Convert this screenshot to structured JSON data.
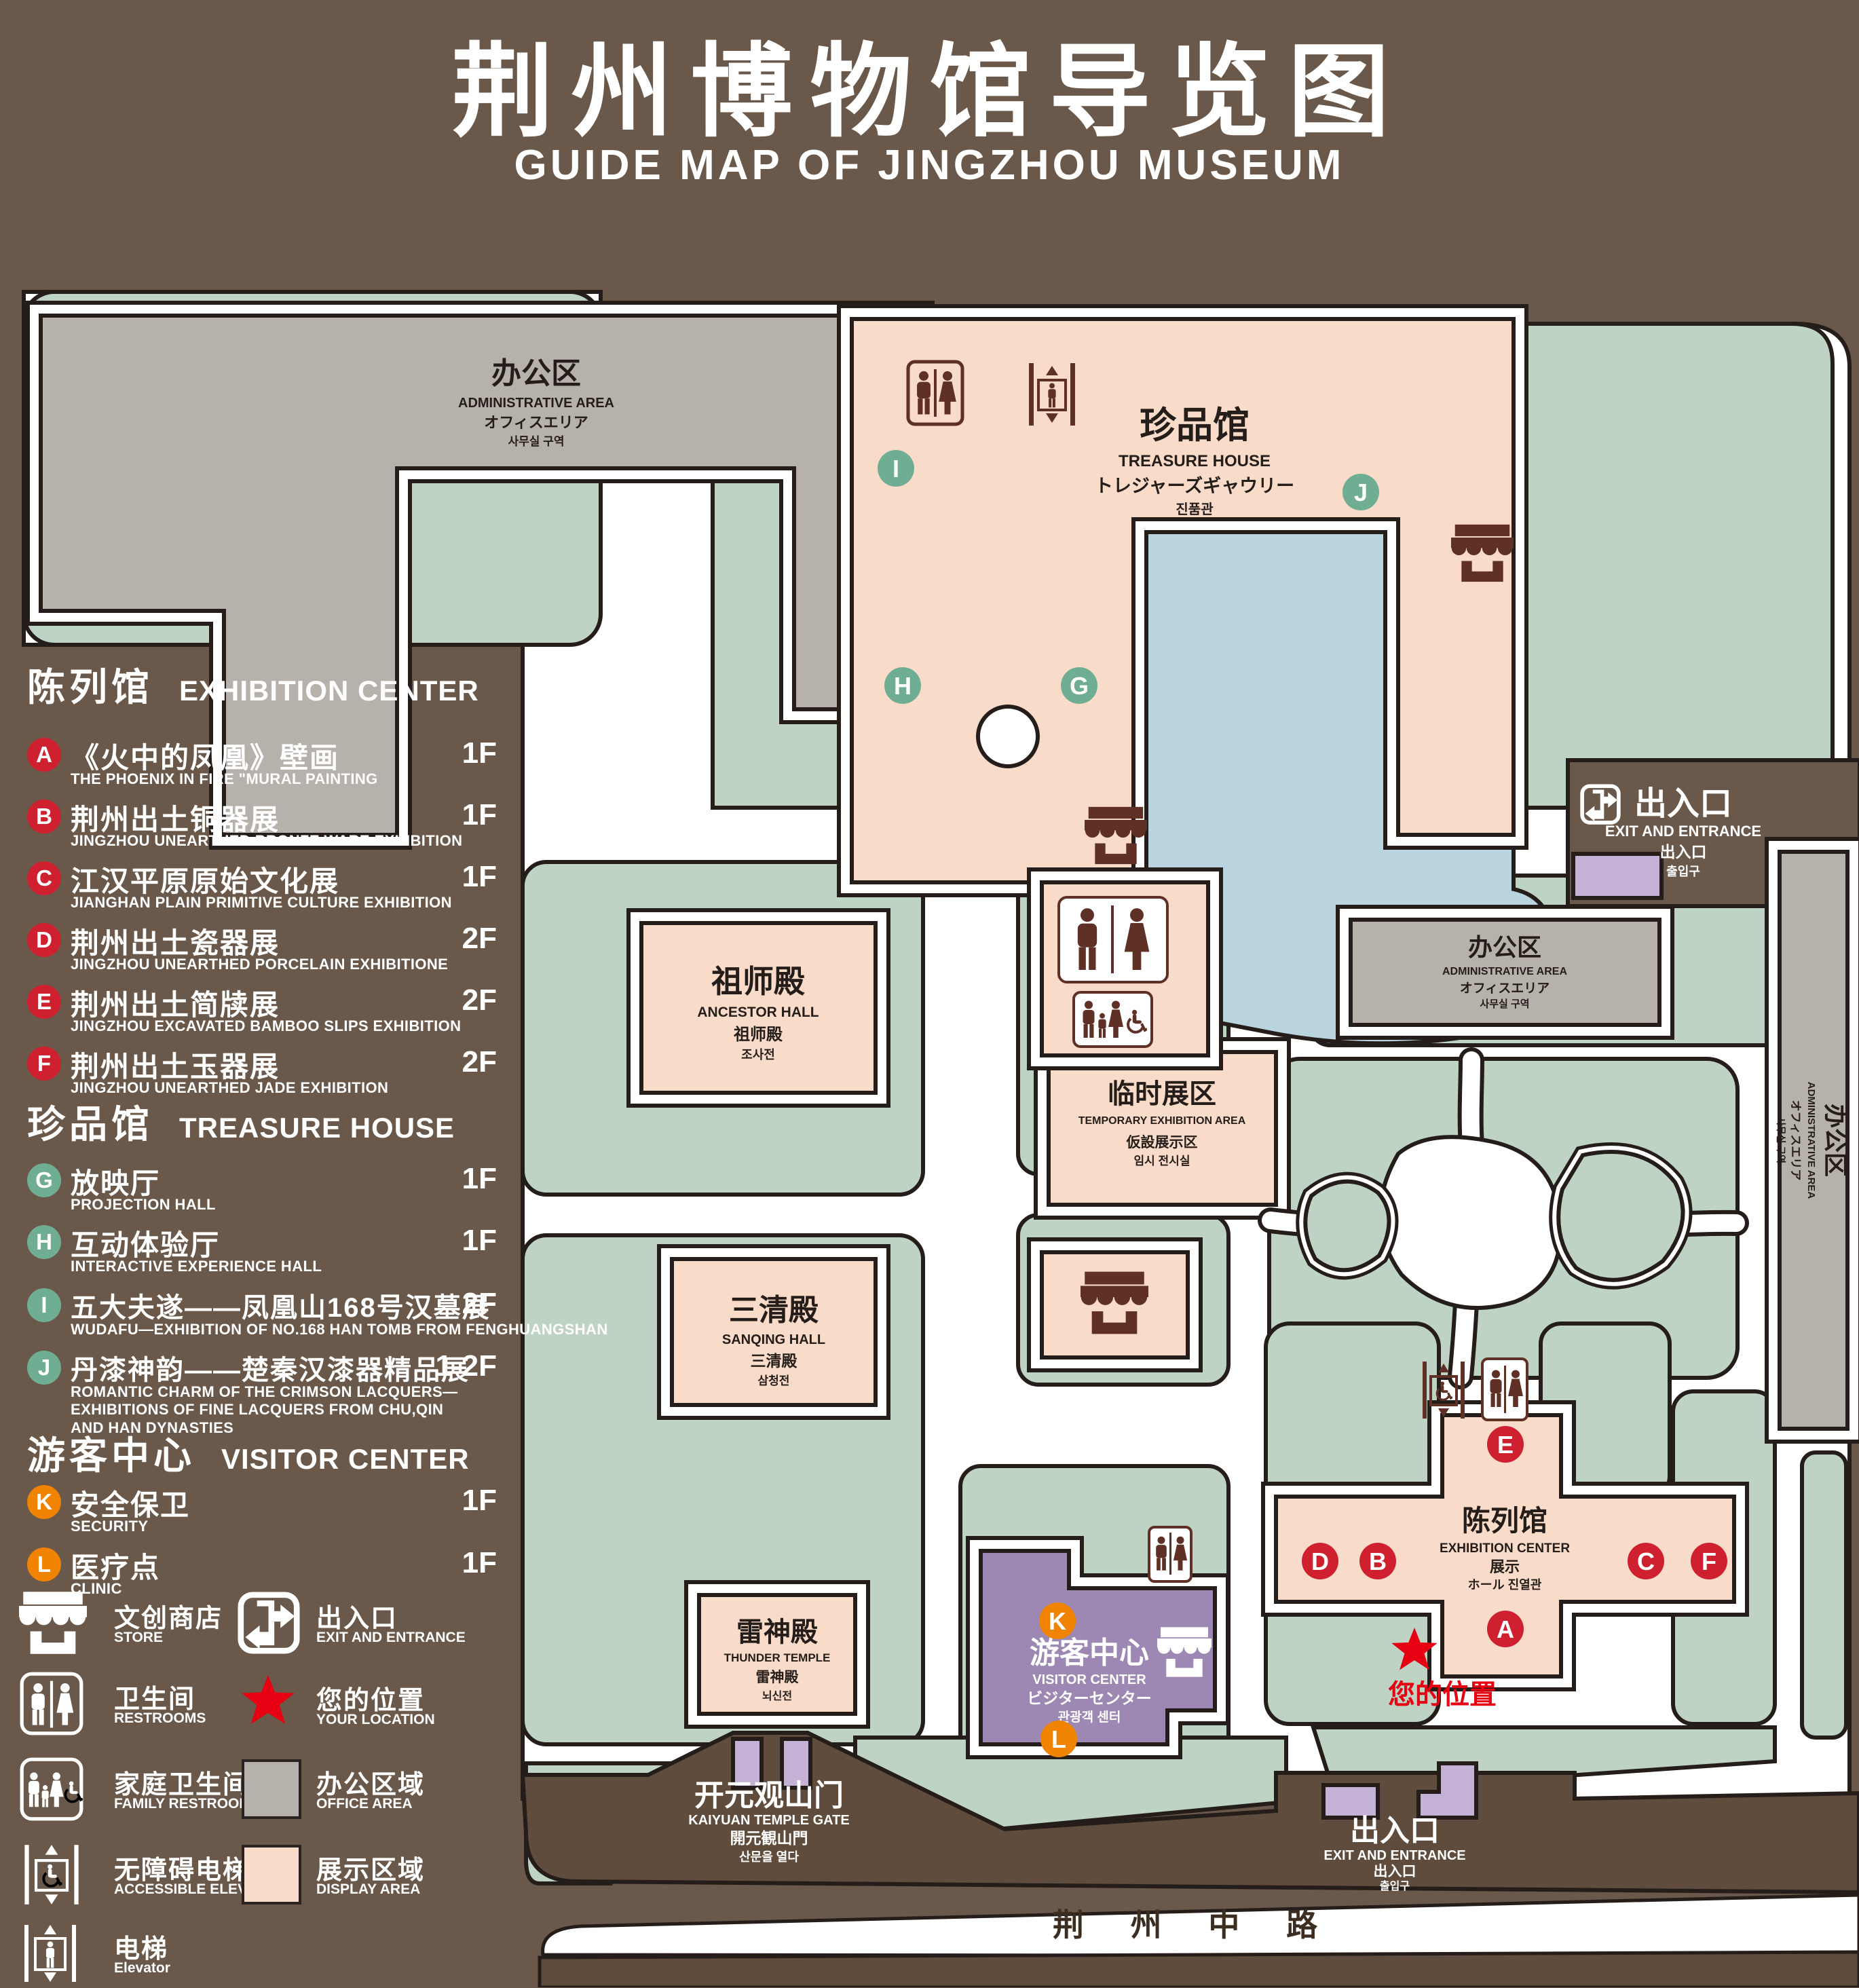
{
  "title": {
    "zh": "荆州博物馆导览图",
    "en": "GUIDE MAP OF JINGZHOU MUSEUM"
  },
  "colors": {
    "background": "#6a594b",
    "road": "#5f4c3c",
    "green_area": "#bfd3c4",
    "display_area": "#f8dbc9",
    "office_area": "#b7b1ac",
    "pond": "#b9d4df",
    "visitor_center": "#9c88b2",
    "gate_booth": "#c4b2d6",
    "badge_exhibition": "#cf2030",
    "badge_treasure": "#6fae92",
    "badge_visitor": "#f08300",
    "icon_brown": "#5e3026",
    "location_red": "#e60012"
  },
  "legend": {
    "sections": [
      {
        "zh": "陈列馆",
        "en": "EXHIBITION CENTER",
        "items": [
          {
            "letter": "A",
            "zh": "《火中的凤凰》壁画",
            "en": "THE PHOENIX IN FIRE \"MURAL PAINTING",
            "floor": "1F"
          },
          {
            "letter": "B",
            "zh": "荆州出土铜器展",
            "en": "JINGZHOU UNEARTHED BRONZE WARE EXHIBITION",
            "floor": "1F"
          },
          {
            "letter": "C",
            "zh": "江汉平原原始文化展",
            "en": "JIANGHAN PLAIN PRIMITIVE CULTURE EXHIBITION",
            "floor": "1F"
          },
          {
            "letter": "D",
            "zh": "荆州出土瓷器展",
            "en": "JINGZHOU UNEARTHED PORCELAIN EXHIBITIONE",
            "floor": "2F"
          },
          {
            "letter": "E",
            "zh": "荆州出土简牍展",
            "en": "JINGZHOU EXCAVATED BAMBOO SLIPS EXHIBITION",
            "floor": "2F"
          },
          {
            "letter": "F",
            "zh": "荆州出土玉器展",
            "en": "JINGZHOU UNEARTHED JADE EXHIBITION",
            "floor": "2F"
          }
        ]
      },
      {
        "zh": "珍品馆",
        "en": "TREASURE HOUSE",
        "items": [
          {
            "letter": "G",
            "zh": "放映厅",
            "en": "PROJECTION HALL",
            "floor": "1F"
          },
          {
            "letter": "H",
            "zh": "互动体验厅",
            "en": "INTERACTIVE EXPERIENCE HALL",
            "floor": "1F"
          },
          {
            "letter": "I",
            "zh": "五大夫遂——凤凰山168号汉墓展",
            "en": "WUDAFU—EXHIBITION OF NO.168 HAN TOMB FROM FENGHUANGSHAN",
            "floor": "2F"
          },
          {
            "letter": "J",
            "zh": "丹漆神韵——楚秦汉漆器精品展",
            "en": "ROMANTIC CHARM OF THE CRIMSON LACQUERS—EXHIBITIONS OF FINE LACQUERS FROM CHU,QIN AND HAN DYNASTIES",
            "floor": "1-2F"
          }
        ]
      },
      {
        "zh": "游客中心",
        "en": "VISITOR CENTER",
        "items": [
          {
            "letter": "K",
            "zh": "安全保卫",
            "en": "SECURITY",
            "floor": "1F"
          },
          {
            "letter": "L",
            "zh": "医疗点",
            "en": "CLINIC",
            "floor": "1F"
          }
        ]
      }
    ],
    "symbols": [
      {
        "icon": "store-icon",
        "zh": "文创商店",
        "en": "STORE"
      },
      {
        "icon": "restrooms-icon",
        "zh": "卫生间",
        "en": "RESTROOMS"
      },
      {
        "icon": "family-restrooms-icon",
        "zh": "家庭卫生间",
        "en": "FAMILY RESTROOMS"
      },
      {
        "icon": "accessible-elevator-icon",
        "zh": "无障碍电梯",
        "en": "ACCESSIBLE  ELEVATOR"
      },
      {
        "icon": "elevator-icon",
        "zh": "电梯",
        "en": "Elevator"
      },
      {
        "icon": "exit-icon",
        "zh": "出入口",
        "en": "EXIT AND ENTRANCE"
      },
      {
        "icon": "location-star-icon",
        "zh": "您的位置",
        "en": "YOUR LOCATION"
      },
      {
        "icon": "office-area-swatch",
        "zh": "办公区域",
        "en": "OFFICE AREA"
      },
      {
        "icon": "display-area-swatch",
        "zh": "展示区域",
        "en": "DISPLAY AREA"
      }
    ]
  },
  "map": {
    "admin": {
      "zh": "办公区",
      "en": "ADMINISTRATIVE AREA",
      "jp": "オフィスエリア",
      "kr": "사무실 구역"
    },
    "treasure": {
      "zh": "珍品馆",
      "en": "TREASURE HOUSE",
      "jp": "トレジャーズギャウリー",
      "kr": "진품관"
    },
    "ancestor": {
      "zh": "祖师殿",
      "en": "ANCESTOR HALL",
      "jp": "祖师殿",
      "kr": "조사전"
    },
    "sanqing": {
      "zh": "三清殿",
      "en": "SANQING HALL",
      "jp": "三清殿",
      "kr": "삼청전"
    },
    "thunder": {
      "zh": "雷神殿",
      "en": "THUNDER TEMPLE",
      "jp": "雷神殿",
      "kr": "뇌신전"
    },
    "temporary": {
      "zh": "临时展区",
      "en": "TEMPORARY EXHIBITION AREA",
      "jp": "仮設展示区",
      "kr": "임시 전시실"
    },
    "visitor": {
      "zh": "游客中心",
      "en": "VISITOR CENTER",
      "jp": "ビジターセンター",
      "kr": "관광객 센터"
    },
    "exhibition": {
      "zh": "陈列馆",
      "en": "EXHIBITION CENTER",
      "l3": "展示",
      "l4": "ホール 진열관"
    },
    "exit": {
      "zh": "出入口",
      "en": "EXIT AND ENTRANCE",
      "jp": "出入口",
      "kr": "출입구"
    },
    "gate": {
      "zh": "开元观山门",
      "en": "KAIYUAN TEMPLE GATE",
      "jp": "開元観山門",
      "kr": "산문을 열다"
    },
    "road": "荆 州 中 路",
    "your_location": "您的位置",
    "badges": {
      "a": "A",
      "b": "B",
      "c": "C",
      "d": "D",
      "e": "E",
      "f": "F",
      "g": "G",
      "h": "H",
      "i": "I",
      "j": "J",
      "k": "K",
      "l": "L"
    }
  }
}
